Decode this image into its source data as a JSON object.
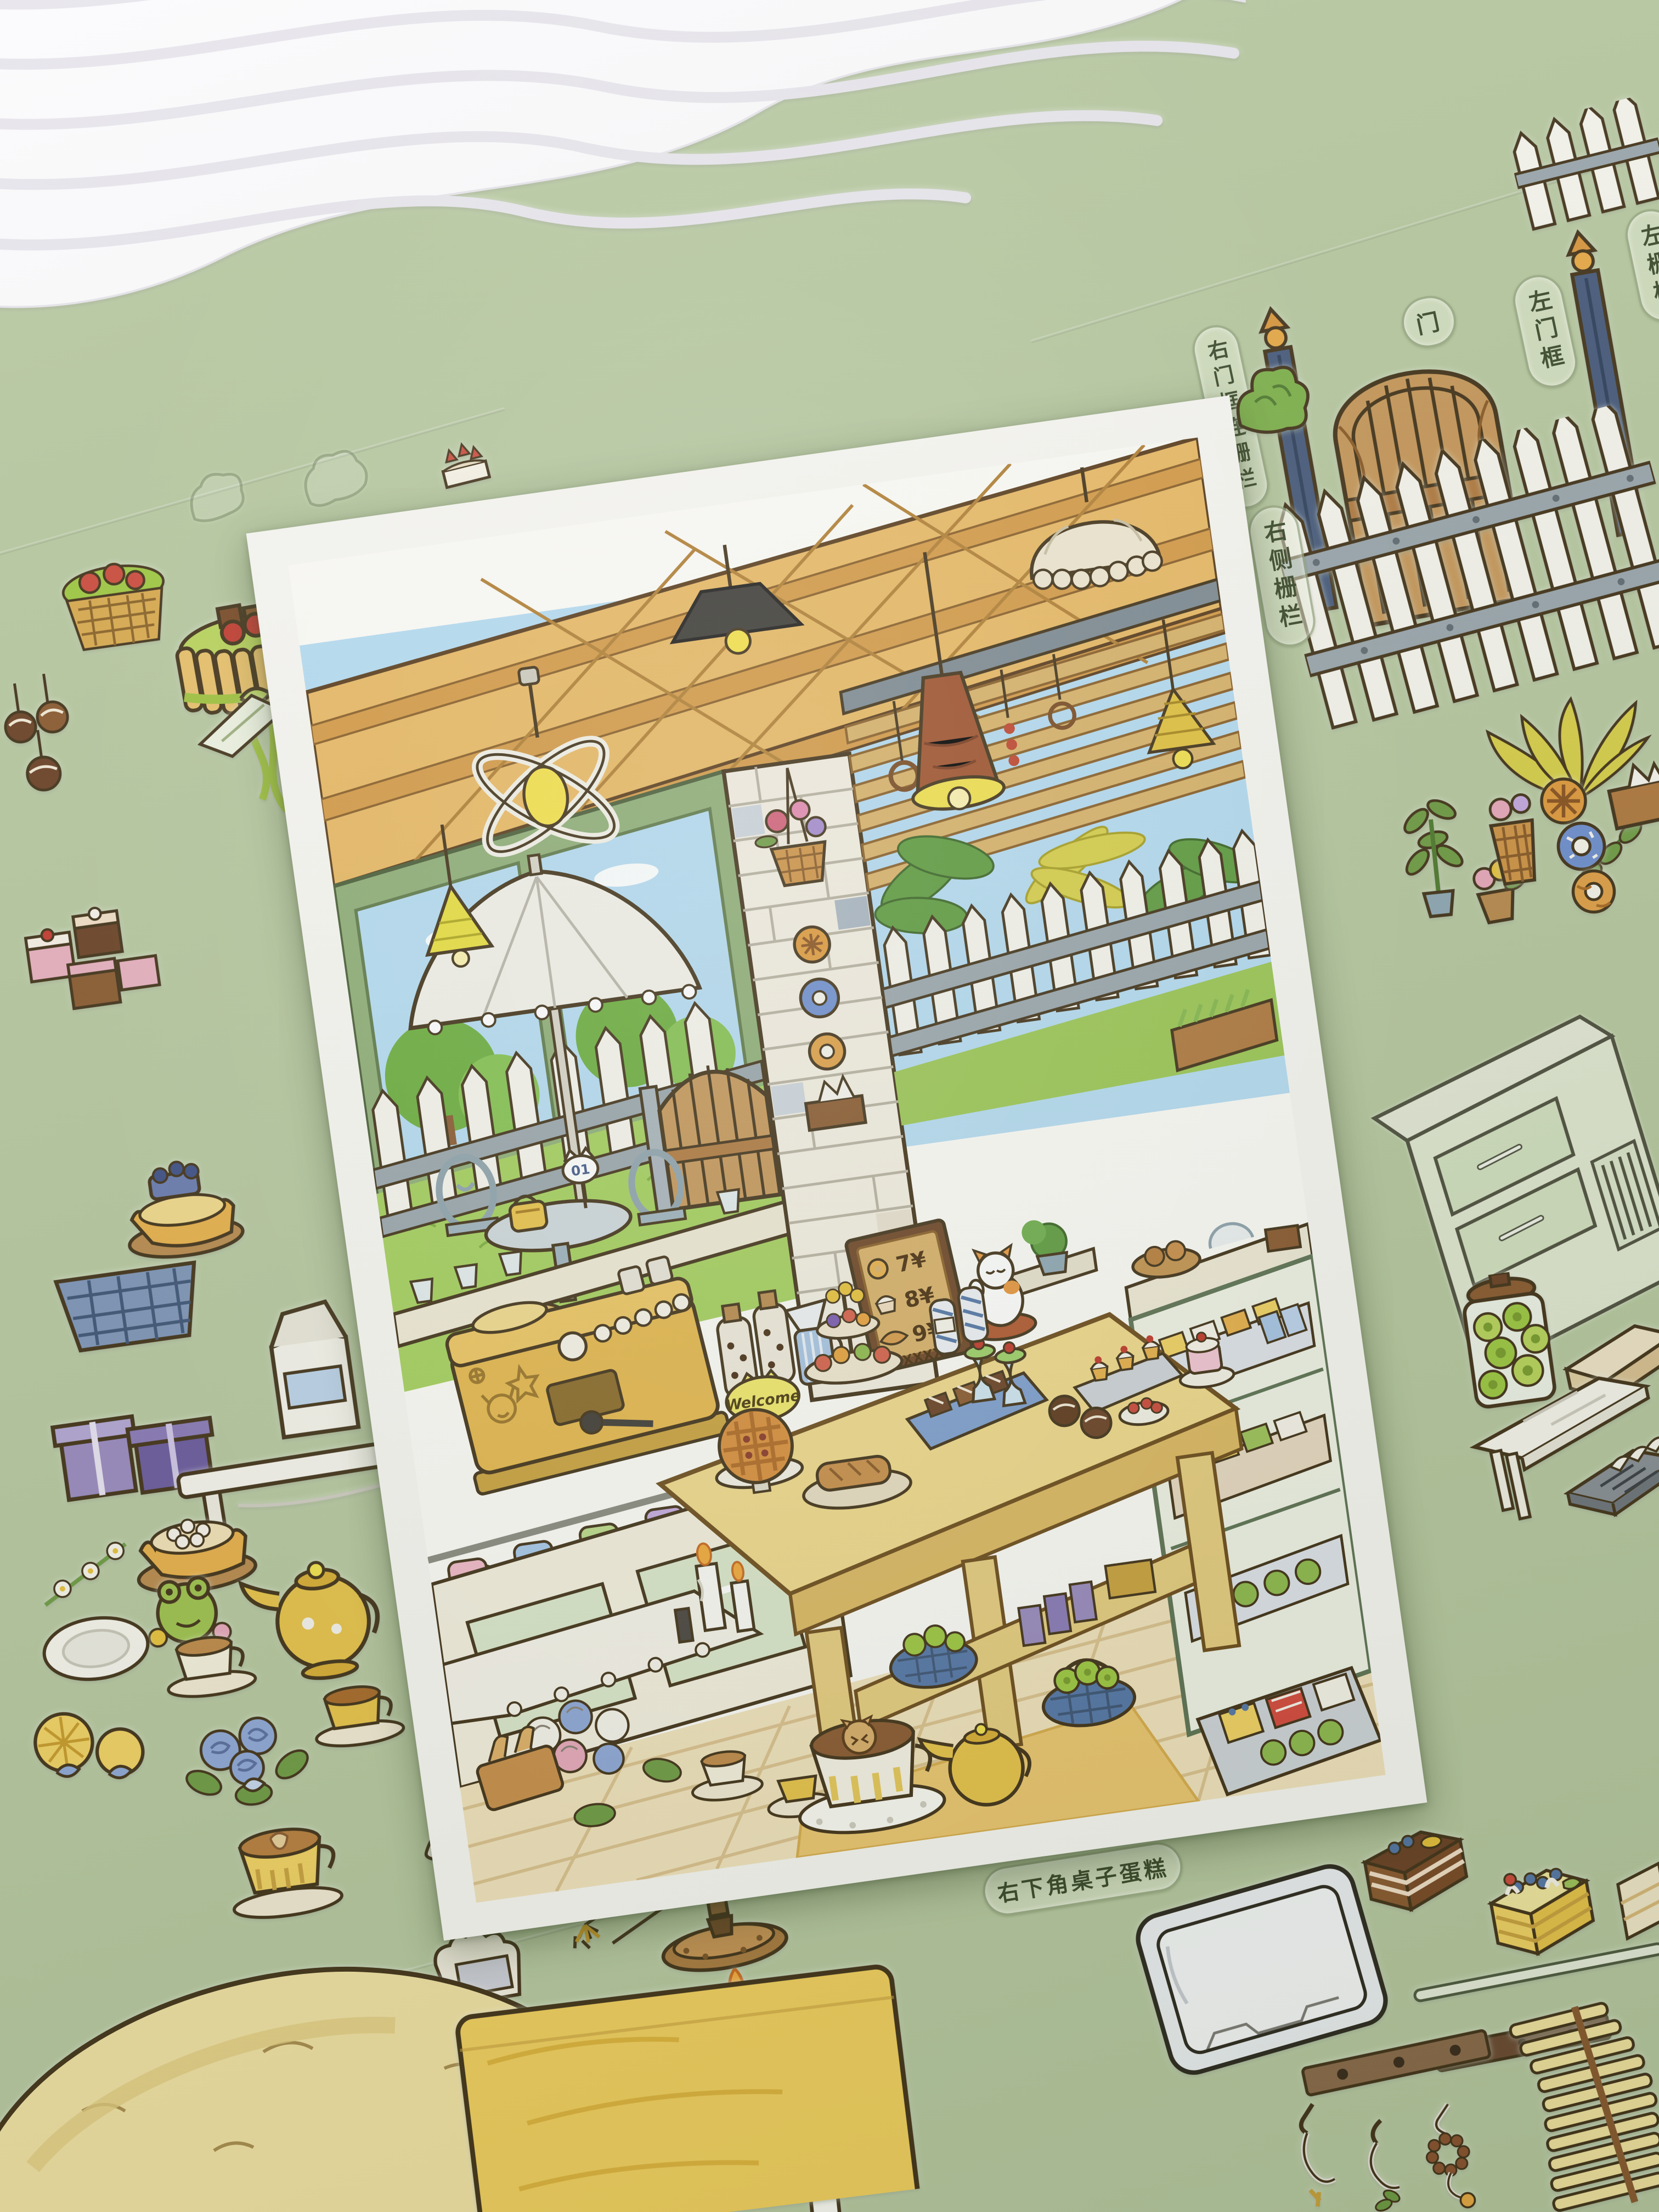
{
  "labels": {
    "window_elements": "窗外元素",
    "right_door_frame_fence": "右门框连栅栏",
    "door": "门",
    "left_door_frame": "左门框",
    "left_fence": "左栅栏",
    "right_side_fence": "右侧栅栏",
    "bottom_right_table_cake": "右下角桌子蛋糕"
  },
  "poster": {
    "welcome_sign": "Welcome",
    "table_number_sign": "01",
    "menu_board": {
      "rows": [
        {
          "icon": "donut-icon",
          "price": "7¥"
        },
        {
          "icon": "cupcake-icon",
          "price": "8¥"
        },
        {
          "icon": "croissant-icon",
          "price": "9¥"
        }
      ],
      "footer": "B:XXXXX"
    }
  },
  "colors": {
    "background": "#b7c8a0",
    "poster_border": "#f8f7f3",
    "ceiling_wood": "#e9b964",
    "beam_wood": "#d59a46",
    "sky": "#b5dcf3",
    "grass": "#a5d05e",
    "foliage": "#6f9c45",
    "fence_white": "#f6f5ee",
    "rail_grey": "#9aa6ad",
    "gate_wood": "#c6975a",
    "table_wood": "#f0d98c",
    "counter_cream": "#efe9d6",
    "cabinet_green": "#dbe7cb",
    "machine_yellow": "#e5b74d",
    "menu_board_face": "#d9b169",
    "menu_board_frame": "#6e4526",
    "floor_tile": "#f2e3bd",
    "lamp_yellow": "#f2e14d",
    "accent_red": "#c44b3f",
    "accent_blue": "#7f9fd0",
    "label_text": "#3c4a2c"
  }
}
